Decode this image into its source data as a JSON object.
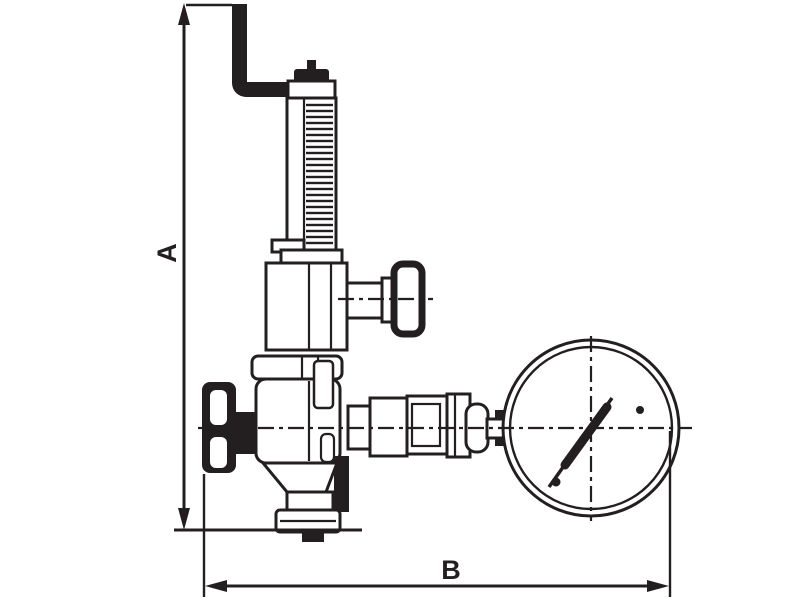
{
  "meta": {
    "background": "#ffffff",
    "ink": "#231f20",
    "drawing_kind": "technical dimensional line drawing"
  },
  "dimensions": {
    "a": {
      "label": "A",
      "orientation": "vertical"
    },
    "b": {
      "label": "B",
      "orientation": "horizontal"
    }
  },
  "parts": [
    "safety-relief-pipe",
    "spring-housing",
    "spring-coils",
    "bonnet",
    "tee-handle-valve",
    "union-nut",
    "regulator-body",
    "handwheel",
    "outlet-flange",
    "gauge-connection",
    "pressure-gauge",
    "gauge-needle"
  ]
}
